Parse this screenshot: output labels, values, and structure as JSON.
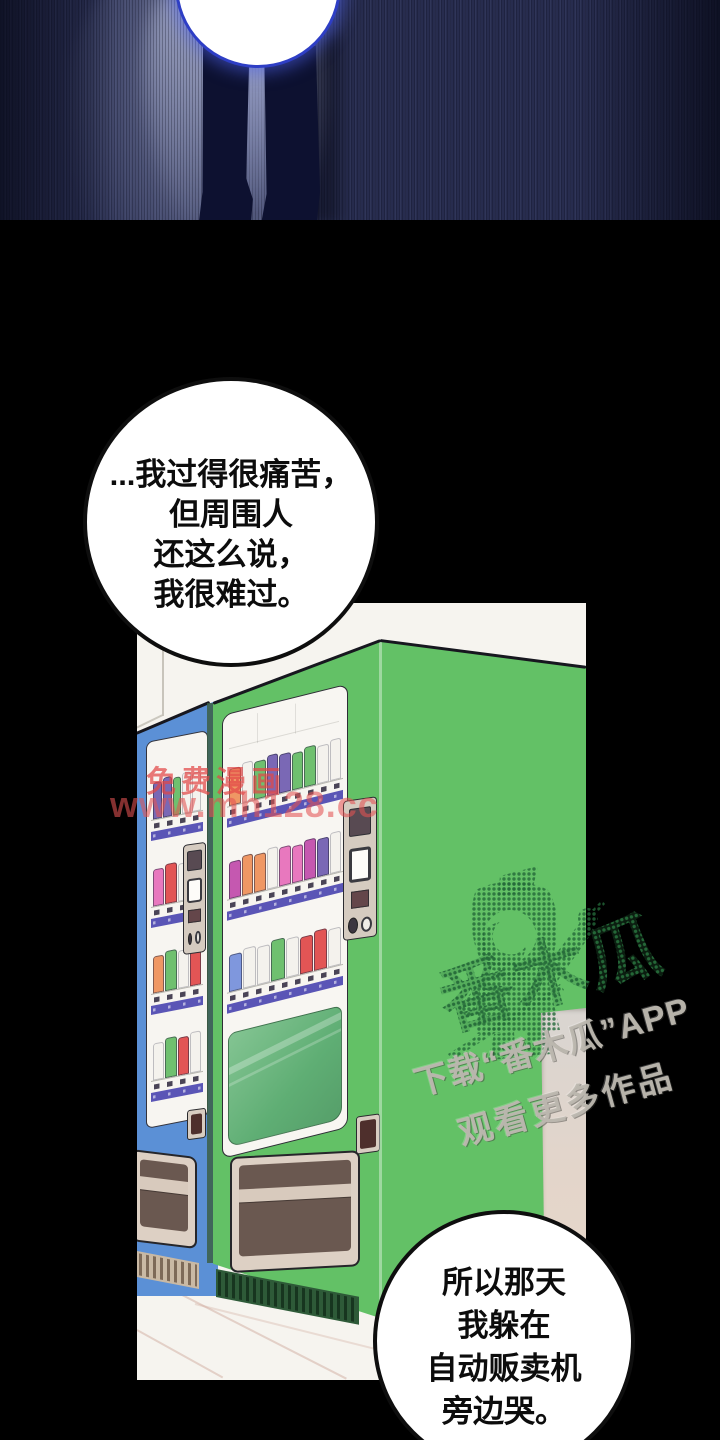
{
  "page": {
    "background": "#000000"
  },
  "top_panel": {
    "description": "night scene, standing figure legs silhouette with glowing white orb",
    "bg_color": "#272c4e",
    "legs_color": "#0d1130",
    "orb_color": "#ffffff",
    "orb_ring_color": "#2e3ec5"
  },
  "speech_bubble_1": {
    "lines": [
      "...我过得很痛苦，",
      "但周围人",
      "还这么说，",
      "我很难过。"
    ]
  },
  "speech_bubble_2": {
    "lines": [
      "所以那天",
      "我躲在",
      "自动贩卖机",
      "旁边哭。"
    ]
  },
  "vending_panel": {
    "wall_color": "#f6f4ef",
    "price_strip_color": "#5a55b6",
    "green_machine": {
      "body_color": "#63c166",
      "glass_color": "#5fae74",
      "shelves": [
        [
          "#ef9764",
          "#f4f2ed",
          "#6fc06f",
          "#7a68b5",
          "#7a68b5",
          "#6fc06f",
          "#6fc06f",
          "#f4f2ed",
          "#f4f2ed"
        ],
        [
          "#c558b0",
          "#ef9764",
          "#ef9764",
          "#f4f2ed",
          "#e878be",
          "#e878be",
          "#c558b0",
          "#7a68b5",
          "#f4f2ed"
        ],
        [
          "#7f97dd",
          "#f4f2ed",
          "#f4f2ed",
          "#6fc06f",
          "#f4f2ed",
          "#e25555",
          "#e25555",
          "#f4f2ed"
        ]
      ]
    },
    "blue_machine": {
      "body_color": "#5b90d6",
      "shelves": [
        [
          "#7a68b5",
          "#7a68b5",
          "#6fc06f",
          "#f4f2ed",
          "#f4f2ed"
        ],
        [
          "#e878be",
          "#e25555",
          "#f4f2ed",
          "#ef9764"
        ],
        [
          "#ef9764",
          "#6fc06f",
          "#f4f2ed",
          "#e25555"
        ],
        [
          "#f4f2ed",
          "#6fc06f",
          "#e25555",
          "#f4f2ed"
        ]
      ]
    },
    "tray_outer_color": "#ddd0c4",
    "tray_inner_color": "#6a5850",
    "pillar_top_color": "#d9d5d1",
    "pillar_bottom_color": "#ead8ca"
  },
  "watermark_red": {
    "line1": "免费漫画",
    "line2": "www.mh128.cc",
    "color": "#e04848"
  },
  "watermark_papaya": {
    "big_text": "番木瓜",
    "line1": "下载“番木瓜”APP",
    "line2": "观看更多作品",
    "dot_color": "#2c743e",
    "text_color": "#bdb8b0"
  }
}
